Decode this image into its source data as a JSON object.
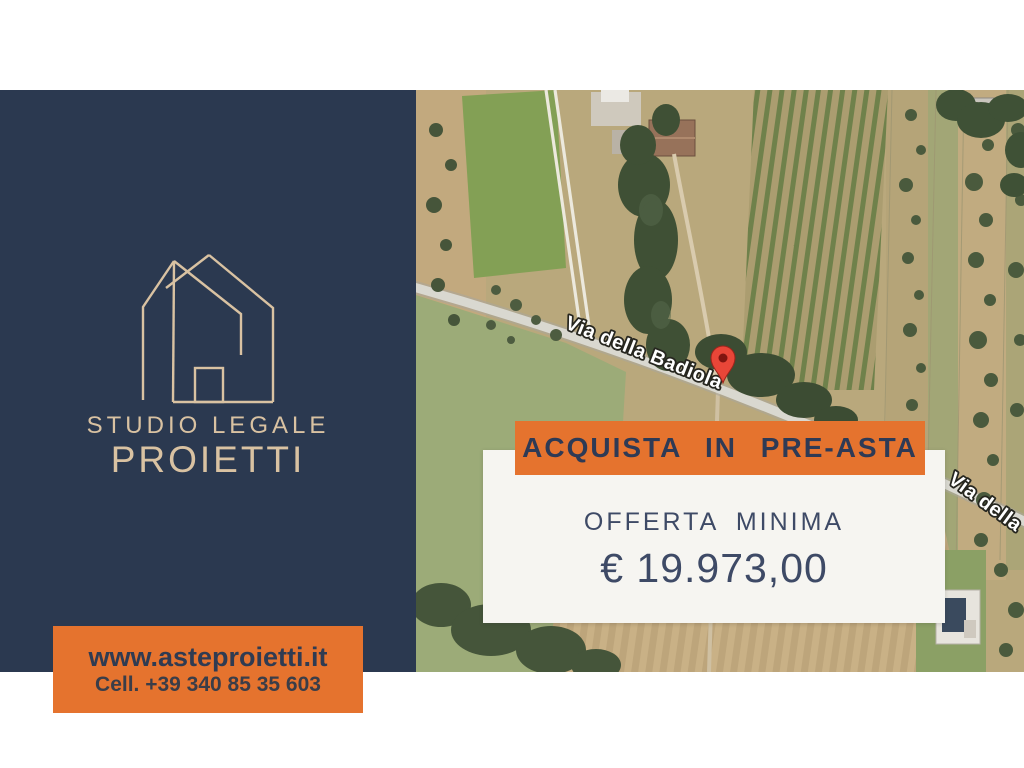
{
  "brand": {
    "studio_line": "STUDIO LEGALE",
    "name_line": "PROIETTI",
    "website": "www.asteproietti.it",
    "phone": "Cell. +39 340 85 35 603"
  },
  "banner": {
    "label": "ACQUISTA IN PRE-ASTA"
  },
  "offer": {
    "heading": "OFFERTA MINIMA",
    "amount": "€ 19.973,00"
  },
  "map": {
    "street_label_main": "Via della Badiola",
    "street_label_partial": "Via della"
  },
  "icons": {
    "logo": "house-outline-icon",
    "pin": "map-pin-icon"
  },
  "colors": {
    "navy": "#2b3950",
    "orange": "#e5732e",
    "tan": "#d9c2a2",
    "dark_text": "#2e3a55",
    "card_bg": "#f6f5f1",
    "pin_red": "#e94638"
  }
}
